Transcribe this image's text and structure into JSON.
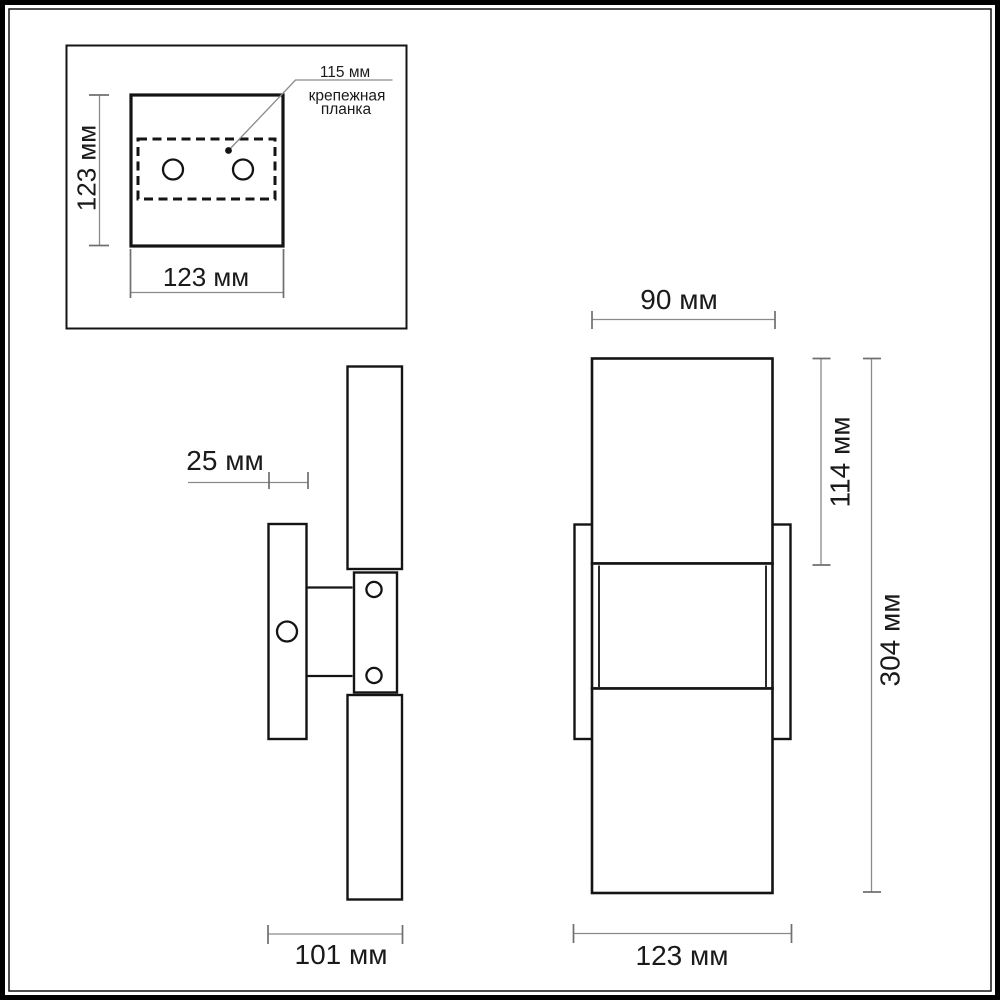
{
  "drawing": {
    "background_color": "#ffffff",
    "outline_color": "#141414",
    "dimension_color": "#8a8a8a",
    "text_color": "#1a1a1a",
    "mounting_inset": {
      "hole_spacing_label": "115 мм",
      "plate_callout_line1": "крепежная",
      "plate_callout_line2": "планка",
      "height_label": "123 мм",
      "width_label": "123 мм"
    },
    "side_view": {
      "plate_depth_label": "25 мм",
      "total_depth_label": "101 мм"
    },
    "front_view": {
      "tube_width_label": "90 мм",
      "upper_tube_height_label": "114 мм",
      "total_height_label": "304 мм",
      "plate_width_label": "123 мм"
    }
  }
}
